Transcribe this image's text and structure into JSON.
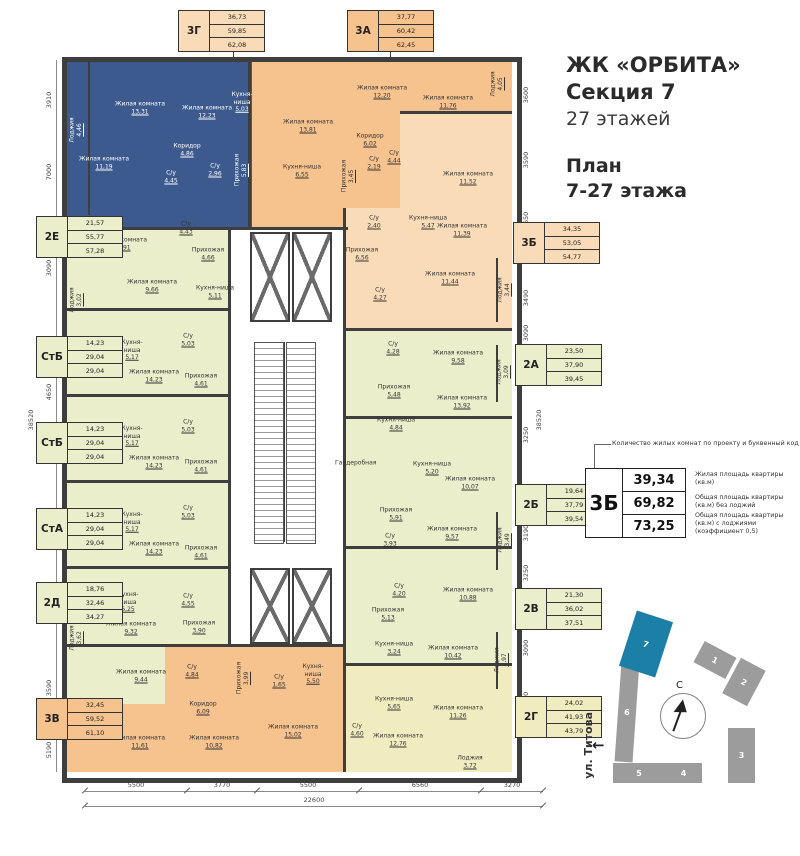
{
  "title": {
    "project": "ЖК «ОРБИТА»",
    "section": "Секция 7",
    "floors": "27 этажей",
    "plan1": "План",
    "plan2": "7-27 этажа"
  },
  "legend": {
    "caption": "Количество жилых комнат по проекту и буквенный код",
    "code": "3Б",
    "values": [
      "39,34",
      "69,82",
      "73,25"
    ],
    "labels": [
      "Жилая площадь квартиры (кв.м)",
      "Общая площадь квартиры (кв.м) без лоджий",
      "Общая площадь квартиры (кв.м) с лоджиями (коэффициент 0,5)"
    ]
  },
  "codes": [
    {
      "key": "3g",
      "code": "3Г",
      "tone": "peach",
      "values": [
        "36,73",
        "59,85",
        "62,08"
      ]
    },
    {
      "key": "3a",
      "code": "3А",
      "tone": "orange",
      "values": [
        "37,77",
        "60,42",
        "62,45"
      ]
    },
    {
      "key": "2e",
      "code": "2Е",
      "tone": "green",
      "values": [
        "21,57",
        "55,77",
        "57,28"
      ]
    },
    {
      "key": "stb1",
      "code": "СтБ",
      "tone": "green",
      "values": [
        "14,23",
        "29,04",
        "29,04"
      ]
    },
    {
      "key": "stb2",
      "code": "СтБ",
      "tone": "green",
      "values": [
        "14,23",
        "29,04",
        "29,04"
      ]
    },
    {
      "key": "sta",
      "code": "СтА",
      "tone": "green",
      "values": [
        "14,23",
        "29,04",
        "29,04"
      ]
    },
    {
      "key": "2d",
      "code": "2Д",
      "tone": "green",
      "values": [
        "18,76",
        "32,46",
        "34,27"
      ]
    },
    {
      "key": "3v",
      "code": "3В",
      "tone": "orange",
      "values": [
        "32,45",
        "59,52",
        "61,10"
      ]
    },
    {
      "key": "3b",
      "code": "3Б",
      "tone": "peach",
      "values": [
        "34,35",
        "53,05",
        "54,77"
      ]
    },
    {
      "key": "2a",
      "code": "2А",
      "tone": "green",
      "values": [
        "23,50",
        "37,90",
        "39,45"
      ]
    },
    {
      "key": "2b",
      "code": "2Б",
      "tone": "green",
      "values": [
        "19,64",
        "37,79",
        "39,54"
      ]
    },
    {
      "key": "2v",
      "code": "2В",
      "tone": "green",
      "values": [
        "21,30",
        "36,02",
        "37,51"
      ]
    },
    {
      "key": "2g",
      "code": "2Г",
      "tone": "cream",
      "values": [
        "24,02",
        "41,93",
        "43,79"
      ]
    }
  ],
  "apartments": [
    {
      "key": "apt3g",
      "tone": "highlight",
      "rooms": [
        {
          "n": "Лоджия",
          "a": "4,46"
        },
        {
          "n": "Жилая комната",
          "a": "13,31"
        },
        {
          "n": "Жилая комната",
          "a": "12,23"
        },
        {
          "n": "Кухня-ниша",
          "a": "5,03"
        },
        {
          "n": "Жилая комната",
          "a": "11,19"
        },
        {
          "n": "Коридор",
          "a": "4,86"
        },
        {
          "n": "С/у",
          "a": "4,45"
        },
        {
          "n": "С/у",
          "a": "2,96"
        },
        {
          "n": "Прихожая",
          "a": "5,83"
        }
      ]
    },
    {
      "key": "apt3a",
      "tone": "orange",
      "rooms": [
        {
          "n": "Жилая комната",
          "a": "13,81"
        },
        {
          "n": "Жилая комната",
          "a": "12,20"
        },
        {
          "n": "Жилая комната",
          "a": "11,76"
        },
        {
          "n": "Кухня-ниша",
          "a": "6,55"
        },
        {
          "n": "Коридор",
          "a": "6,02"
        },
        {
          "n": "Прихожая",
          "a": "3,45"
        },
        {
          "n": "С/у",
          "a": "2,19"
        },
        {
          "n": "С/у",
          "a": "4,44"
        },
        {
          "n": "Лоджия",
          "a": "4,05"
        }
      ]
    },
    {
      "key": "apt3b",
      "tone": "peach",
      "rooms": [
        {
          "n": "С/у",
          "a": "2,40"
        },
        {
          "n": "Прихожая",
          "a": "6,56"
        },
        {
          "n": "С/у",
          "a": "4,27"
        },
        {
          "n": "Кухня-ниша",
          "a": "5,47"
        },
        {
          "n": "Жилая комната",
          "a": "11,52"
        },
        {
          "n": "Жилая комната",
          "a": "11,39"
        },
        {
          "n": "Жилая комната",
          "a": "11,44"
        },
        {
          "n": "Лоджия",
          "a": "3,44"
        }
      ]
    },
    {
      "key": "apt2a",
      "tone": "green",
      "rooms": [
        {
          "n": "С/у",
          "a": "4,28"
        },
        {
          "n": "Жилая комната",
          "a": "9,58"
        },
        {
          "n": "Прихожая",
          "a": "5,48"
        },
        {
          "n": "Кухня-ниша",
          "a": "4,84"
        },
        {
          "n": "Жилая комната",
          "a": "13,92"
        },
        {
          "n": "Лоджия",
          "a": "3,09"
        }
      ]
    },
    {
      "key": "apt2b",
      "tone": "green",
      "rooms": [
        {
          "n": "Гардеробная",
          "a": ""
        },
        {
          "n": "Кухня-ниша",
          "a": "5,20"
        },
        {
          "n": "Жилая комната",
          "a": "10,07"
        },
        {
          "n": "Прихожая",
          "a": "5,91"
        },
        {
          "n": "С/у",
          "a": "3,93"
        },
        {
          "n": "Жилая комната",
          "a": "9,57"
        },
        {
          "n": "Лоджия",
          "a": "3,49"
        }
      ]
    },
    {
      "key": "apt2v",
      "tone": "green",
      "rooms": [
        {
          "n": "С/у",
          "a": "4,20"
        },
        {
          "n": "Жилая комната",
          "a": "10,88"
        },
        {
          "n": "Прихожая",
          "a": "5,13"
        },
        {
          "n": "Кухня-ниша",
          "a": "3,24"
        },
        {
          "n": "Жилая комната",
          "a": "10,42"
        },
        {
          "n": "Лоджия",
          "a": "2,97"
        }
      ]
    },
    {
      "key": "apt2g",
      "tone": "cream",
      "rooms": [
        {
          "n": "Кухня-ниша",
          "a": "5,65"
        },
        {
          "n": "Жилая комната",
          "a": "11,26"
        },
        {
          "n": "С/у",
          "a": "4,60"
        },
        {
          "n": "Жилая комната",
          "a": "12,76"
        },
        {
          "n": "Лоджия",
          "a": "3,72"
        }
      ]
    },
    {
      "key": "apt2e",
      "tone": "green",
      "rooms": [
        {
          "n": "Жилая комната",
          "a": "11,91"
        },
        {
          "n": "С/у",
          "a": "4,43"
        },
        {
          "n": "Прихожая",
          "a": "4,66"
        },
        {
          "n": "Жилая комната",
          "a": "9,66"
        },
        {
          "n": "Кухня-ниша",
          "a": "5,11"
        },
        {
          "n": "Лоджия",
          "a": "3,02"
        }
      ]
    },
    {
      "key": "stb1",
      "tone": "green",
      "rooms": [
        {
          "n": "Кухня-ниша",
          "a": "5,17"
        },
        {
          "n": "С/у",
          "a": "5,03"
        },
        {
          "n": "Жилая комната",
          "a": "14,23"
        },
        {
          "n": "Прихожая",
          "a": "4,61"
        }
      ]
    },
    {
      "key": "stb2",
      "tone": "green",
      "rooms": [
        {
          "n": "Кухня-ниша",
          "a": "5,17"
        },
        {
          "n": "С/у",
          "a": "5,03"
        },
        {
          "n": "Жилая комната",
          "a": "14,23"
        },
        {
          "n": "Прихожая",
          "a": "4,61"
        }
      ]
    },
    {
      "key": "sta",
      "tone": "green",
      "rooms": [
        {
          "n": "Кухня-ниша",
          "a": "5,17"
        },
        {
          "n": "С/у",
          "a": "5,03"
        },
        {
          "n": "Жилая комната",
          "a": "14,23"
        },
        {
          "n": "Прихожая",
          "a": "4,61"
        }
      ]
    },
    {
      "key": "apt3v",
      "tone": "orange",
      "rooms": [
        {
          "n": "С/у",
          "a": "4,84"
        },
        {
          "n": "Жилая комната",
          "a": "11,61"
        },
        {
          "n": "Коридор",
          "a": "6,09"
        },
        {
          "n": "Прихожая",
          "a": "3,99"
        },
        {
          "n": "С/у",
          "a": "1,65"
        },
        {
          "n": "Кухня-ниша",
          "a": "5,50"
        },
        {
          "n": "Жилая комната",
          "a": "10,82"
        },
        {
          "n": "Жилая комната",
          "a": "15,02"
        },
        {
          "n": "Лоджия",
          "a": "3,55"
        }
      ]
    },
    {
      "key": "apt2d",
      "tone": "green",
      "rooms": [
        {
          "n": "Кухня-ниша",
          "a": "5,25"
        },
        {
          "n": "С/у",
          "a": "4,55"
        },
        {
          "n": "Жилая комната",
          "a": "9,32"
        },
        {
          "n": "Прихожая",
          "a": "3,90"
        },
        {
          "n": "Жилая комната",
          "a": "9,44"
        },
        {
          "n": "Лоджия",
          "a": "3,62"
        }
      ]
    }
  ],
  "dimensions": {
    "bottom": [
      "5500",
      "3770",
      "5500",
      "6560",
      "3270"
    ],
    "bottom_total": "22600",
    "left": [
      "3910",
      "7000",
      "3090",
      "4650",
      "4650",
      "3850",
      "3590",
      "5190"
    ],
    "left_total": "38520",
    "right": [
      "3600",
      "3590",
      "5650",
      "3490",
      "3090",
      "3250",
      "3190",
      "3250",
      "3090",
      "4970"
    ],
    "right_total": "38520"
  },
  "site_plan": {
    "street": "ул. Титова",
    "north": "С",
    "buildings": [
      "1",
      "2",
      "3",
      "4",
      "5",
      "6",
      "7"
    ],
    "highlighted": "7"
  },
  "colors": {
    "highlight": "#3c5a8d",
    "orange": "#f6c28e",
    "peach": "#f9dbb7",
    "green": "#eaeecb",
    "cream": "#f1ecc0",
    "wall": "#3f3e3e",
    "site_building": "#9c9c9c",
    "site_highlight": "#1b7fa7"
  }
}
